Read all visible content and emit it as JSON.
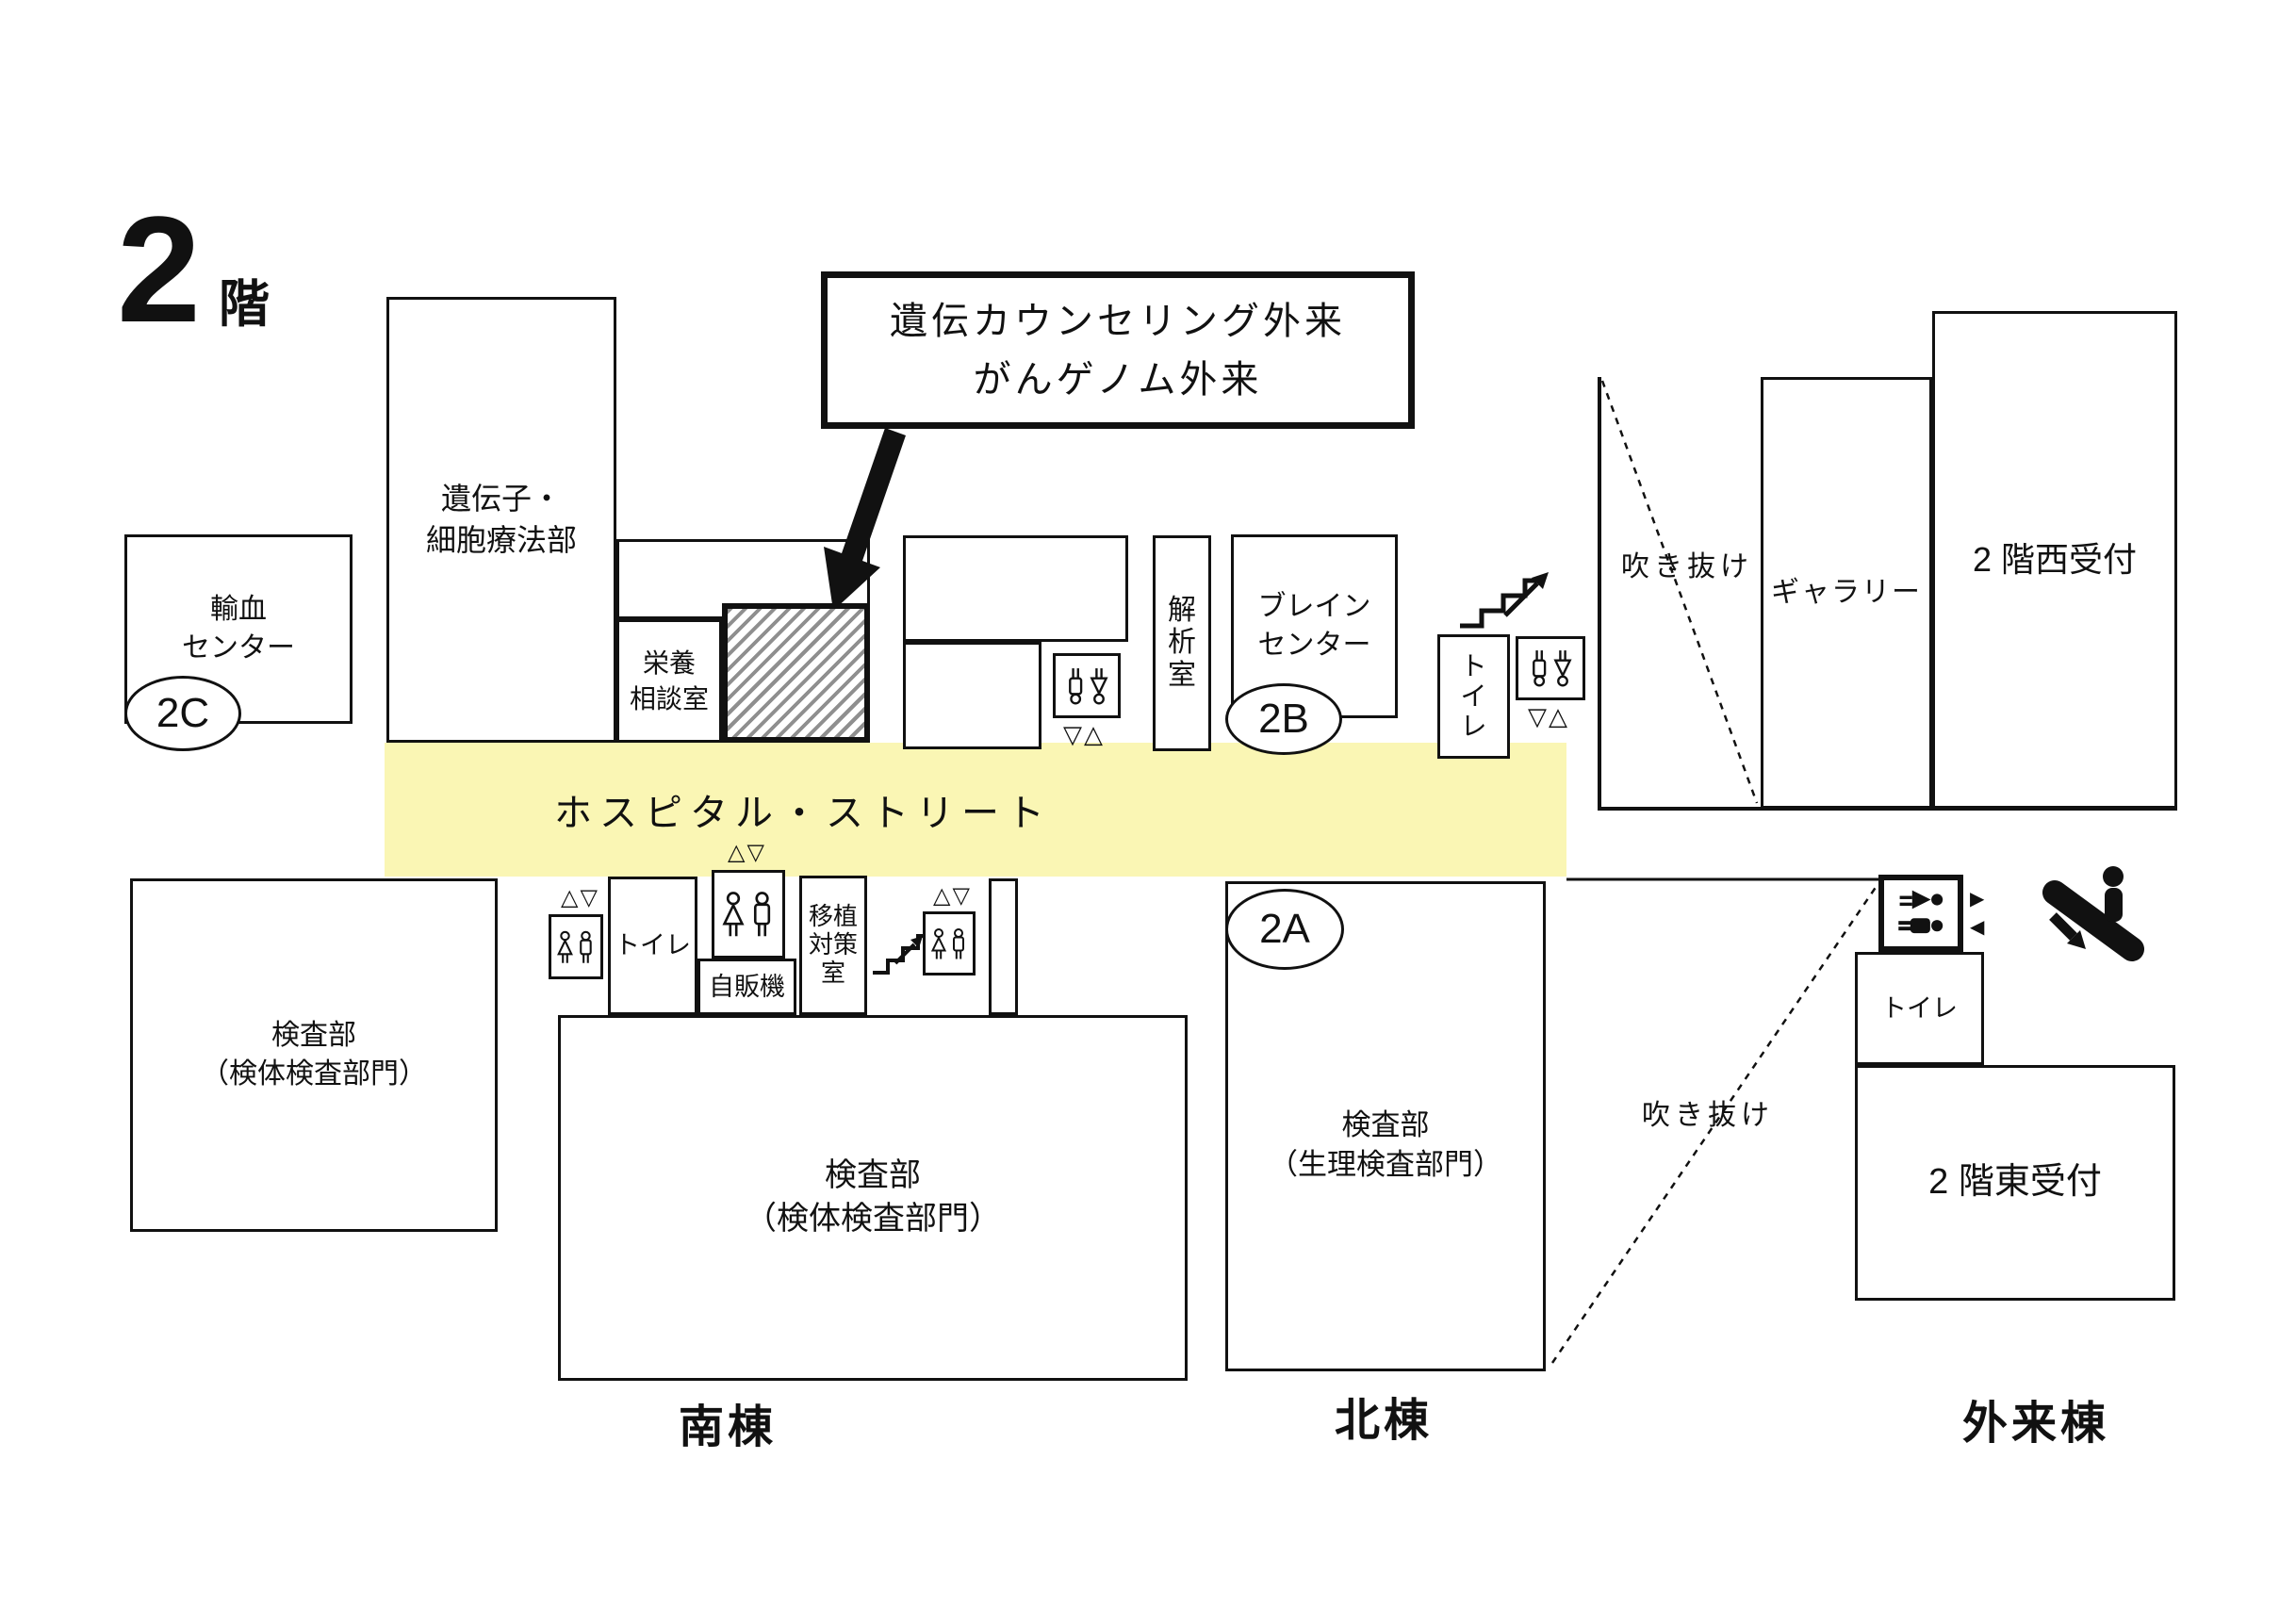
{
  "title": {
    "number": "2",
    "suffix": "階"
  },
  "callout": {
    "lines": [
      "遺伝カウンセリング外来",
      "がんゲノム外来"
    ]
  },
  "street": {
    "label": "ホスピタル・ストリート"
  },
  "badges": {
    "a": "2A",
    "b": "2B",
    "c": "2C"
  },
  "rooms": {
    "gene_cell_therapy": [
      "遺伝子・",
      "細胞療法部"
    ],
    "blood_center": [
      "輸血",
      "センター"
    ],
    "nutrition": [
      "栄養",
      "相談室"
    ],
    "analysis": [
      "解",
      "析",
      "室"
    ],
    "brain_center": [
      "ブレイン",
      "センター"
    ],
    "toilet_north": [
      "ト",
      "イ",
      "レ"
    ],
    "atrium_west": "吹き抜け",
    "gallery": "ギャラリー",
    "west_reception": "2 階西受付",
    "lab_west": [
      "検査部",
      "（検体検査部門）"
    ],
    "toilet_south": "トイレ",
    "vending": "自販機",
    "transplant": [
      "移植",
      "対策",
      "室"
    ],
    "lab_south": [
      "検査部",
      "（検体検査部門）"
    ],
    "lab_north": [
      "検査部",
      "（生理検査部門）"
    ],
    "atrium_east": "吹き抜け",
    "toilet_east": "トイレ",
    "east_reception": "2 階東受付"
  },
  "buildings": {
    "south": "南棟",
    "north": "北棟",
    "outpatient": "外来棟"
  },
  "markers": {
    "south_elevator": "△▽",
    "north_elevator": "▽△",
    "door_right": "▶",
    "door_left": "◀"
  },
  "icons": {
    "elevator": "elevator-passengers-icon",
    "stairs": "stairs-icon",
    "escalator": "escalator-down-icon",
    "restroom": "restroom-icon"
  },
  "colors": {
    "street": "#FAF6B4",
    "line": "#111111",
    "hatch": "#8f8f8f"
  }
}
